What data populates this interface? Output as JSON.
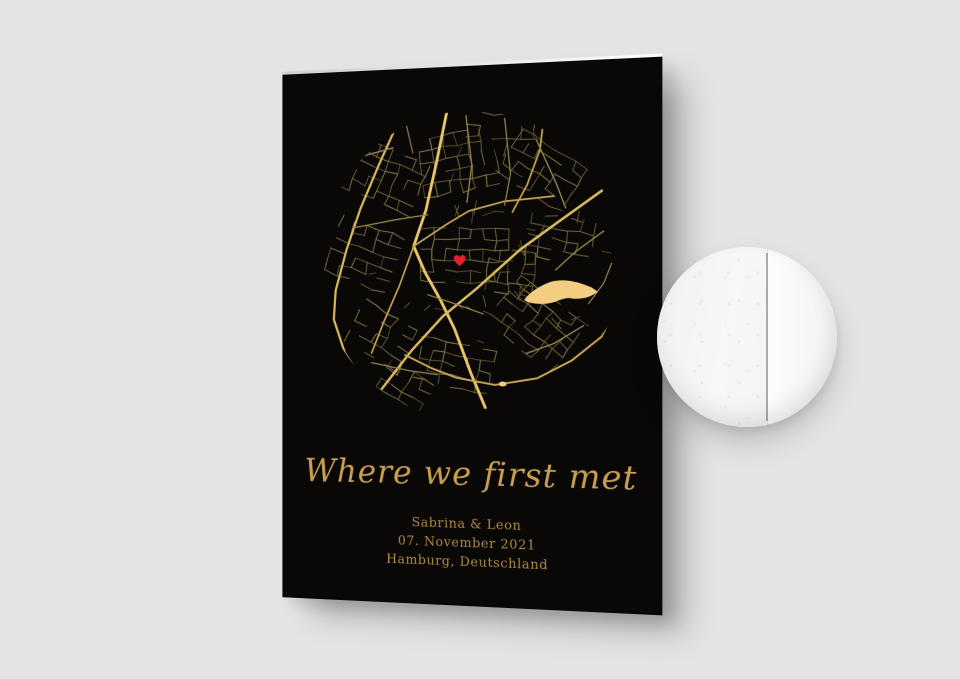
{
  "scene": {
    "background_color": "#e5e4e3"
  },
  "poster": {
    "background_color": "#0a0707",
    "title": "Where we first met",
    "title_color": "#c79f52",
    "details_color": "#b28d44",
    "details": [
      "Sabrina & Leon",
      "07. November 2021",
      "Hamburg, Deutschland"
    ]
  },
  "map": {
    "marker": "heart",
    "colors": {
      "road_bright": "#e6c76b",
      "road_main": "#d9b85e",
      "road_secondary": "#c6a554",
      "road_mid": "#94844a",
      "street_dim": [
        "#5f5733",
        "#6b6139",
        "#776c3e",
        "#837741"
      ],
      "lake": "#f3cd80",
      "heart": "#e3212c"
    }
  },
  "material_swatch": {
    "surface_color": "#f6f6f4",
    "edge_line_color": "#aaaaa8"
  }
}
